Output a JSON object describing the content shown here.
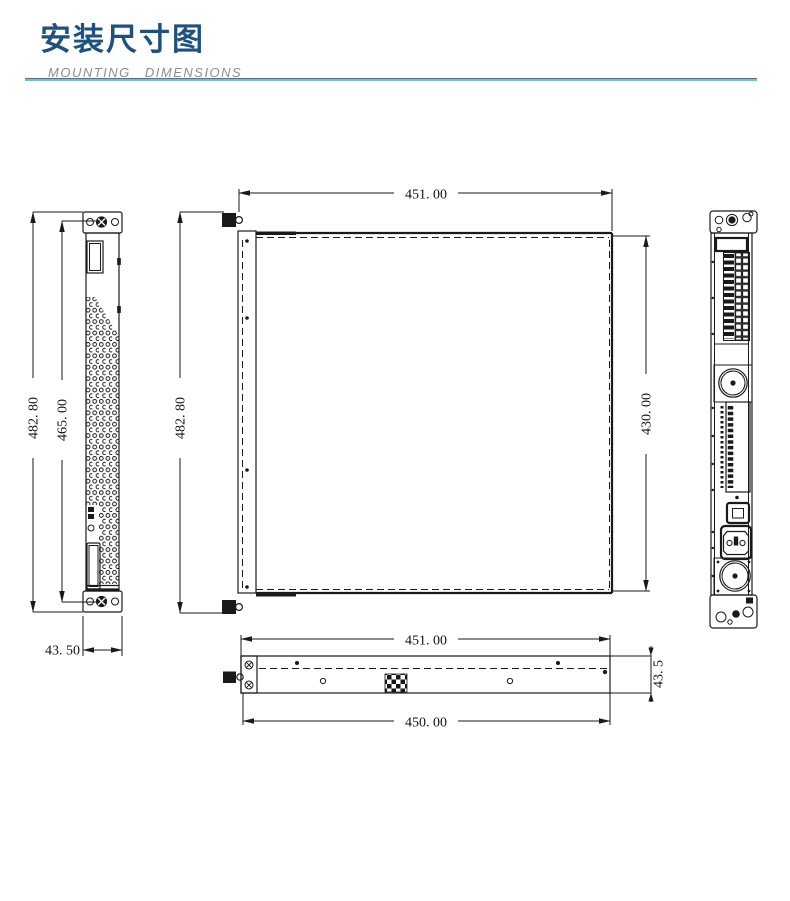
{
  "header": {
    "title": "安装尺寸图",
    "subtitle": "MOUNTING DIMENSIONS",
    "title_color": "#1c5180",
    "rule_top_color": "#53718c",
    "rule_bottom_color": "#7fb6da"
  },
  "drawing": {
    "line_color": "#1a1a1a",
    "background": "#ffffff"
  },
  "dims": {
    "front_total_height": "482. 80",
    "front_hole_pitch": "465. 00",
    "front_width": "43. 50",
    "top_width": "451. 00",
    "top_total_height": "482. 80",
    "top_body_depth": "430. 00",
    "bottom_width_outer": "451. 00",
    "bottom_width_inner": "450. 00",
    "bottom_height": "43. 5"
  },
  "features": {
    "fan_upper": "fan-icon",
    "fan_lower": "fan-icon",
    "power_inlet": "power-inlet-icon",
    "power_switch": "power-switch-icon",
    "screws": "screw-icon",
    "perforations": "vent-dot-pattern",
    "vent_grid": "vent-grid-pattern"
  }
}
